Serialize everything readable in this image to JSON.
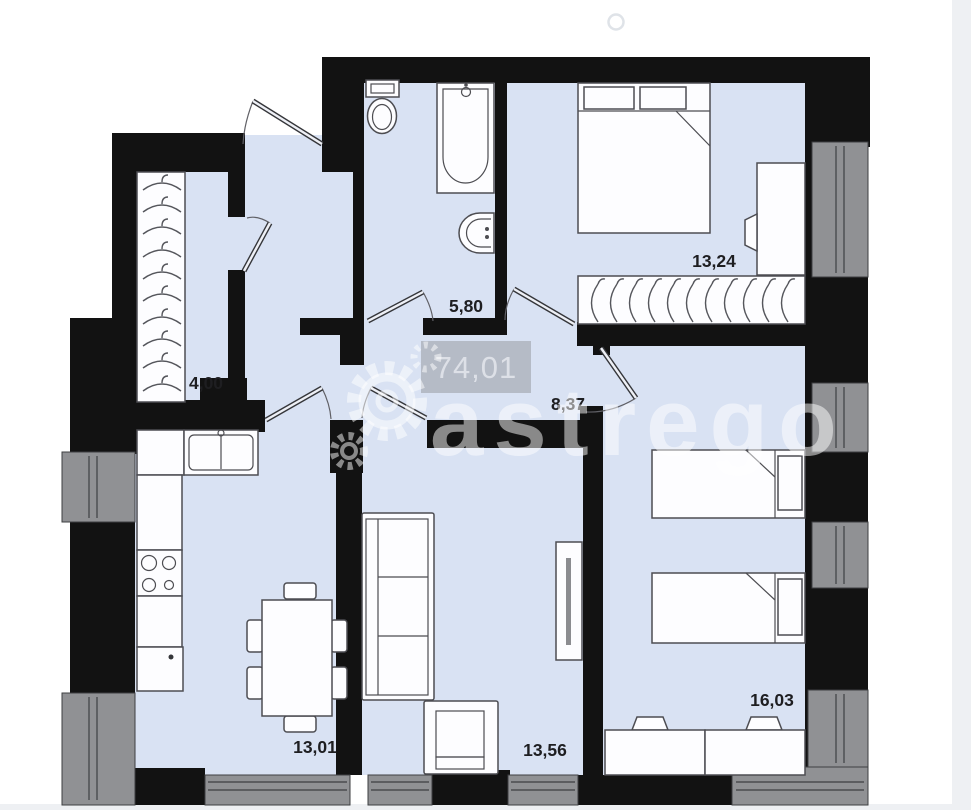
{
  "plan": {
    "total_area_badge": {
      "value": "74,01"
    },
    "watermark": {
      "text": "astrego",
      "logo_icon": "gear-icon"
    },
    "rooms": [
      {
        "id": "wardrobe-hall",
        "area": "4,00"
      },
      {
        "id": "bathroom",
        "area": "5,80"
      },
      {
        "id": "bedroom-1",
        "area": "13,24"
      },
      {
        "id": "hallway",
        "area": "8,37"
      },
      {
        "id": "kitchen-dining",
        "area": "13,01"
      },
      {
        "id": "living-room",
        "area": "13,56"
      },
      {
        "id": "bedroom-2",
        "area": "16,03"
      }
    ],
    "colors": {
      "floor": "#d9e2f3",
      "wall": "#121212",
      "window_fill": "#909194",
      "window_frame": "#3e3f42",
      "furniture_fill": "#fdfdff",
      "furniture_stroke": "#4d4d52",
      "label": "#1e1e21",
      "badge_bg": "#b5bbc6",
      "badge_text": "#dde0e7",
      "watermark": "#ffffff",
      "exterior_band": "#eef0f3"
    }
  }
}
